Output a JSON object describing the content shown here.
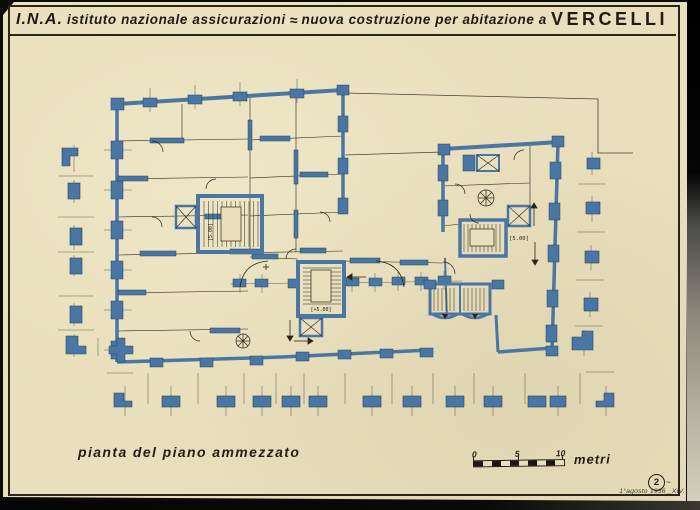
{
  "header": {
    "org_abbr": "I.N.A.",
    "org_name": "istituto nazionale assicurazioni",
    "separator": "≈",
    "project": "nuova costruzione per abitazione a",
    "city": "VERCELLI"
  },
  "plan": {
    "left_stair_level": "[5.00]",
    "central_stair_level": "[+5.00]",
    "right_stair_level": "[5.00]"
  },
  "footer": {
    "caption": "pianta del piano ammezzato",
    "sheet_number": "2",
    "sheet_tail": "~",
    "date": "1°agosto 1936 _XIV."
  },
  "scale_bar": {
    "zero": "0",
    "five": "5",
    "ten": "10",
    "unit": "metri"
  },
  "colors": {
    "paper": "#e9dfbc",
    "ink": "#241d12",
    "wall_blue": "#4a76a3",
    "wall_blue_dark": "#24455f",
    "thin_line": "#554a3c",
    "scan_black": "#0b0b0b"
  }
}
